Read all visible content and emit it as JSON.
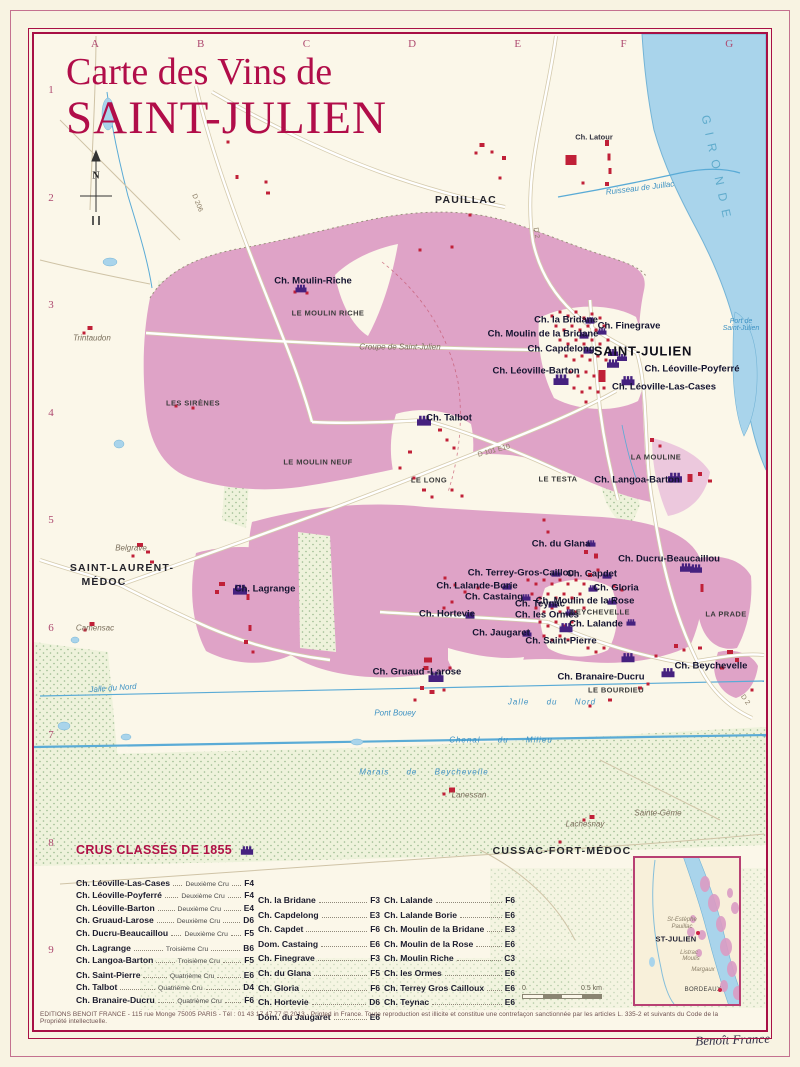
{
  "poster": {
    "title_line1": "Carte des Vins de",
    "title_line2": "SAINT-JULIEN",
    "signature": "Benoît France",
    "footer": "EDITIONS BENOIT FRANCE - 115 rue Monge 75005 PARIS - Tél : 01 43 17 47 77 © 2013 - Printed in France. Toute reproduction est illicite et constitue une contrefaçon sanctionnée par les articles L. 335-2 et suivants du Code de la Propriété intellectuelle."
  },
  "colors": {
    "crimson": "#a80f45",
    "vineyard_pink": "#dfa3c7",
    "water_blue": "#a9d4eb",
    "chateau_purple": "#45217f",
    "building_red": "#c02038",
    "woods_green": "#9cbb90"
  },
  "grid": {
    "letters": [
      "A",
      "B",
      "C",
      "D",
      "E",
      "F",
      "G"
    ],
    "numbers": [
      "1",
      "2",
      "3",
      "4",
      "5",
      "6",
      "7",
      "8",
      "9"
    ]
  },
  "map_labels": [
    {
      "t": "N",
      "x": 96,
      "y": 176,
      "c": "compass-n",
      "n": "compass-north-label"
    },
    {
      "t": "PAUILLAC",
      "x": 466,
      "y": 200,
      "c": "town"
    },
    {
      "t": "SAINT-JULIEN",
      "x": 643,
      "y": 351,
      "c": "town-lg"
    },
    {
      "t": "SAINT-LAURENT-",
      "x": 122,
      "y": 568,
      "c": "town"
    },
    {
      "t": "MÉDOC",
      "x": 104,
      "y": 582,
      "c": "town"
    },
    {
      "t": "CUSSAC-FORT-MÉDOC",
      "x": 562,
      "y": 851,
      "c": "town"
    },
    {
      "t": "GIRONDE",
      "x": 717,
      "y": 170,
      "c": "gironde",
      "r": 78
    },
    {
      "t": "Ch. Latour",
      "x": 594,
      "y": 137,
      "c": "chateau-sm"
    },
    {
      "t": "Ruisseau  de Juillac",
      "x": 640,
      "y": 188,
      "c": "water",
      "r": -7
    },
    {
      "t": "Port de\nSaint-Julien",
      "x": 741,
      "y": 325,
      "c": "water-multi"
    },
    {
      "t": "Trintaudon",
      "x": 92,
      "y": 338,
      "c": "loc"
    },
    {
      "t": "Ch. Moulin-Riche",
      "x": 313,
      "y": 281,
      "c": "chateau"
    },
    {
      "t": "LE MOULIN RICHE",
      "x": 328,
      "y": 313,
      "c": "hamlet"
    },
    {
      "t": "Croupe de Saint-Julien",
      "x": 400,
      "y": 347,
      "c": "loc"
    },
    {
      "t": "LES SIRÈNES",
      "x": 193,
      "y": 403,
      "c": "hamlet"
    },
    {
      "t": "Ch. Talbot",
      "x": 449,
      "y": 418,
      "c": "chateau"
    },
    {
      "t": "LE MOULIN NEUF",
      "x": 318,
      "y": 462,
      "c": "hamlet"
    },
    {
      "t": "LE LONG",
      "x": 429,
      "y": 480,
      "c": "hamlet"
    },
    {
      "t": "LE TESTA",
      "x": 558,
      "y": 479,
      "c": "hamlet"
    },
    {
      "t": "LA MOULINE",
      "x": 656,
      "y": 457,
      "c": "hamlet"
    },
    {
      "t": "Ch. Langoa-Barton",
      "x": 637,
      "y": 480,
      "c": "chateau"
    },
    {
      "t": "Ch. la Bridane",
      "x": 566,
      "y": 320,
      "c": "chateau"
    },
    {
      "t": "Ch. Finegrave",
      "x": 629,
      "y": 326,
      "c": "chateau"
    },
    {
      "t": "Ch. Moulin de la Bridane",
      "x": 543,
      "y": 334,
      "c": "chateau"
    },
    {
      "t": "Ch. Capdelong",
      "x": 561,
      "y": 349,
      "c": "chateau"
    },
    {
      "t": "Ch. Léoville-Barton",
      "x": 536,
      "y": 371,
      "c": "chateau"
    },
    {
      "t": "Ch. Léoville-Poyferré",
      "x": 692,
      "y": 369,
      "c": "chateau"
    },
    {
      "t": "Ch. Léoville-Las-Cases",
      "x": 664,
      "y": 387,
      "c": "chateau"
    },
    {
      "t": "D 101 E10",
      "x": 494,
      "y": 451,
      "c": "road",
      "r": -15
    },
    {
      "t": "D 206",
      "x": 197,
      "y": 203,
      "c": "road",
      "r": 68
    },
    {
      "t": "D 2",
      "x": 536,
      "y": 233,
      "c": "road",
      "r": 80
    },
    {
      "t": "D 2",
      "x": 745,
      "y": 700,
      "c": "road",
      "r": 55
    },
    {
      "t": "Ch. du Glana",
      "x": 561,
      "y": 544,
      "c": "chateau"
    },
    {
      "t": "Ch. Ducru-Beaucaillou",
      "x": 669,
      "y": 559,
      "c": "chateau"
    },
    {
      "t": "Ch. Terrey-Gros-Caillou",
      "x": 521,
      "y": 573,
      "c": "chateau"
    },
    {
      "t": "Ch. Capdet",
      "x": 592,
      "y": 574,
      "c": "chateau"
    },
    {
      "t": "Ch. Lalande-Borie",
      "x": 477,
      "y": 586,
      "c": "chateau"
    },
    {
      "t": "Ch. Gloria",
      "x": 616,
      "y": 588,
      "c": "chateau"
    },
    {
      "t": "Ch. Castaing",
      "x": 494,
      "y": 597,
      "c": "chateau"
    },
    {
      "t": "Ch. Moulin de la Rose",
      "x": 585,
      "y": 601,
      "c": "chateau"
    },
    {
      "t": "BEYCHEVELLE",
      "x": 600,
      "y": 612,
      "c": "hamlet"
    },
    {
      "t": "Ch. Teynac",
      "x": 540,
      "y": 604,
      "c": "chateau"
    },
    {
      "t": "Ch. les Ormes",
      "x": 547,
      "y": 615,
      "c": "chateau"
    },
    {
      "t": "Ch. Hortevie",
      "x": 447,
      "y": 614,
      "c": "chateau"
    },
    {
      "t": "Ch. Lalande",
      "x": 596,
      "y": 624,
      "c": "chateau"
    },
    {
      "t": "Ch. Jaugaret",
      "x": 501,
      "y": 633,
      "c": "chateau"
    },
    {
      "t": "Ch. Saint-Pierre",
      "x": 561,
      "y": 641,
      "c": "chateau"
    },
    {
      "t": "LA PRADE",
      "x": 726,
      "y": 614,
      "c": "hamlet"
    },
    {
      "t": "Ch. Gruaud -Larose",
      "x": 417,
      "y": 672,
      "c": "chateau"
    },
    {
      "t": "Ch. Branaire-Ducru",
      "x": 601,
      "y": 677,
      "c": "chateau"
    },
    {
      "t": "LE BOURDIEU",
      "x": 616,
      "y": 690,
      "c": "hamlet"
    },
    {
      "t": "Ch. Beychevelle",
      "x": 711,
      "y": 666,
      "c": "chateau"
    },
    {
      "t": "Pont Bouey",
      "x": 395,
      "y": 713,
      "c": "water"
    },
    {
      "t": "Jalle  du  Nord",
      "x": 552,
      "y": 702,
      "c": "water-sp"
    },
    {
      "t": "Chenal  du  Milieu",
      "x": 501,
      "y": 740,
      "c": "water-sp"
    },
    {
      "t": "Marais  de  Beychevelle",
      "x": 424,
      "y": 772,
      "c": "water-sp"
    },
    {
      "t": "Lanessan",
      "x": 469,
      "y": 795,
      "c": "loc"
    },
    {
      "t": "Sainte-Gème",
      "x": 658,
      "y": 813,
      "c": "loc"
    },
    {
      "t": "Lachesnay",
      "x": 585,
      "y": 824,
      "c": "loc"
    },
    {
      "t": "Belgrave",
      "x": 131,
      "y": 548,
      "c": "loc"
    },
    {
      "t": "Camensac",
      "x": 95,
      "y": 628,
      "c": "loc"
    },
    {
      "t": "Ch. Lagrange",
      "x": 265,
      "y": 589,
      "c": "chateau"
    },
    {
      "t": "Jalle du Nord",
      "x": 113,
      "y": 688,
      "c": "water",
      "r": -4
    }
  ],
  "chateau_icons": [
    [
      424,
      420,
      1.4
    ],
    [
      561,
      379,
      1.5
    ],
    [
      628,
      380,
      1.3
    ],
    [
      613,
      363,
      1.2
    ],
    [
      675,
      477,
      1.4
    ],
    [
      240,
      589,
      1.4
    ],
    [
      436,
      676,
      1.5
    ],
    [
      566,
      627,
      1.3
    ],
    [
      628,
      657,
      1.3
    ],
    [
      668,
      672,
      1.3
    ],
    [
      686,
      567,
      1.2
    ],
    [
      696,
      568,
      1.2
    ],
    [
      301,
      288,
      1.1
    ],
    [
      590,
      320,
      0.9
    ],
    [
      602,
      331,
      0.9
    ],
    [
      584,
      335,
      0.9
    ],
    [
      588,
      350,
      0.9
    ],
    [
      591,
      543,
      0.9
    ],
    [
      607,
      575,
      0.9
    ],
    [
      593,
      588,
      0.9
    ],
    [
      507,
      586,
      0.9
    ],
    [
      526,
      597,
      0.9
    ],
    [
      470,
      615,
      0.9
    ],
    [
      553,
      604,
      0.9
    ],
    [
      570,
      612,
      0.9
    ],
    [
      631,
      622,
      0.9
    ],
    [
      527,
      633,
      0.9
    ],
    [
      612,
      601,
      0.9
    ],
    [
      556,
      573,
      0.9
    ],
    [
      613,
      352,
      1
    ],
    [
      622,
      357,
      1
    ]
  ],
  "buildings": [
    [
      482,
      145,
      5,
      4
    ],
    [
      492,
      152
    ],
    [
      504,
      158,
      4,
      4
    ],
    [
      476,
      153
    ],
    [
      571,
      160,
      11,
      10
    ],
    [
      607,
      143,
      4,
      6
    ],
    [
      609,
      157,
      3,
      7
    ],
    [
      610,
      171,
      3,
      6
    ],
    [
      607,
      184,
      4,
      4
    ],
    [
      583,
      183
    ],
    [
      500,
      178
    ],
    [
      470,
      215
    ],
    [
      452,
      247
    ],
    [
      420,
      250
    ],
    [
      228,
      142
    ],
    [
      237,
      177,
      3,
      4
    ],
    [
      266,
      182
    ],
    [
      268,
      193,
      4,
      3
    ],
    [
      90,
      328,
      5,
      4
    ],
    [
      84,
      333
    ],
    [
      295,
      292
    ],
    [
      307,
      293
    ],
    [
      176,
      406
    ],
    [
      193,
      408
    ],
    [
      440,
      430,
      4,
      3
    ],
    [
      447,
      440
    ],
    [
      454,
      448
    ],
    [
      410,
      452,
      4,
      3
    ],
    [
      400,
      468
    ],
    [
      414,
      478
    ],
    [
      424,
      490,
      4,
      3
    ],
    [
      432,
      497
    ],
    [
      452,
      490
    ],
    [
      462,
      496
    ],
    [
      552,
      316
    ],
    [
      560,
      312
    ],
    [
      568,
      316
    ],
    [
      576,
      312
    ],
    [
      584,
      318
    ],
    [
      592,
      314
    ],
    [
      600,
      318
    ],
    [
      556,
      326
    ],
    [
      564,
      330
    ],
    [
      572,
      326
    ],
    [
      580,
      330
    ],
    [
      588,
      326
    ],
    [
      596,
      330
    ],
    [
      604,
      326
    ],
    [
      560,
      340
    ],
    [
      568,
      344
    ],
    [
      576,
      340
    ],
    [
      584,
      344
    ],
    [
      592,
      340
    ],
    [
      600,
      344
    ],
    [
      608,
      340
    ],
    [
      566,
      356
    ],
    [
      574,
      360
    ],
    [
      582,
      356
    ],
    [
      590,
      360
    ],
    [
      598,
      356
    ],
    [
      606,
      360
    ],
    [
      570,
      372
    ],
    [
      578,
      376
    ],
    [
      586,
      372
    ],
    [
      594,
      376
    ],
    [
      602,
      372
    ],
    [
      574,
      388
    ],
    [
      582,
      392
    ],
    [
      590,
      388
    ],
    [
      598,
      392
    ],
    [
      604,
      388
    ],
    [
      586,
      402
    ],
    [
      602,
      376,
      7,
      12
    ],
    [
      652,
      440,
      4,
      4
    ],
    [
      660,
      446
    ],
    [
      690,
      478,
      5,
      8
    ],
    [
      700,
      474,
      4,
      4
    ],
    [
      710,
      481,
      4,
      3
    ],
    [
      544,
      520
    ],
    [
      548,
      532
    ],
    [
      586,
      552,
      4,
      4
    ],
    [
      596,
      556,
      4,
      5
    ],
    [
      614,
      586
    ],
    [
      622,
      590
    ],
    [
      702,
      588,
      3,
      8
    ],
    [
      445,
      578
    ],
    [
      455,
      585
    ],
    [
      465,
      592
    ],
    [
      478,
      588
    ],
    [
      452,
      602
    ],
    [
      444,
      608
    ],
    [
      528,
      580
    ],
    [
      536,
      584
    ],
    [
      544,
      580
    ],
    [
      552,
      584
    ],
    [
      560,
      580
    ],
    [
      568,
      584
    ],
    [
      576,
      580
    ],
    [
      584,
      584
    ],
    [
      532,
      594
    ],
    [
      540,
      598
    ],
    [
      548,
      594
    ],
    [
      556,
      598
    ],
    [
      564,
      594
    ],
    [
      572,
      598
    ],
    [
      580,
      594
    ],
    [
      536,
      608
    ],
    [
      544,
      612
    ],
    [
      552,
      608
    ],
    [
      560,
      612
    ],
    [
      568,
      608
    ],
    [
      576,
      612
    ],
    [
      584,
      608
    ],
    [
      540,
      622
    ],
    [
      548,
      626
    ],
    [
      556,
      622
    ],
    [
      564,
      626
    ],
    [
      572,
      622
    ],
    [
      544,
      636
    ],
    [
      552,
      640
    ],
    [
      560,
      636
    ],
    [
      568,
      640
    ],
    [
      590,
      575,
      4,
      4
    ],
    [
      598,
      570
    ],
    [
      222,
      584,
      6,
      4
    ],
    [
      217,
      592,
      4,
      4
    ],
    [
      248,
      597,
      3,
      6
    ],
    [
      250,
      628,
      3,
      6
    ],
    [
      246,
      642,
      4,
      4
    ],
    [
      253,
      652
    ],
    [
      140,
      545,
      6,
      4
    ],
    [
      148,
      552,
      4,
      3
    ],
    [
      133,
      556
    ],
    [
      152,
      562,
      4,
      3
    ],
    [
      92,
      624,
      5,
      4
    ],
    [
      85,
      630
    ],
    [
      428,
      660,
      8,
      5
    ],
    [
      426,
      668,
      5,
      4
    ],
    [
      422,
      688,
      4,
      4
    ],
    [
      432,
      692,
      5,
      4
    ],
    [
      444,
      690
    ],
    [
      450,
      668
    ],
    [
      415,
      700
    ],
    [
      588,
      648
    ],
    [
      596,
      652
    ],
    [
      604,
      648
    ],
    [
      640,
      688,
      4,
      3
    ],
    [
      648,
      684
    ],
    [
      610,
      700,
      4,
      3
    ],
    [
      590,
      706
    ],
    [
      656,
      656
    ],
    [
      730,
      652,
      6,
      4
    ],
    [
      737,
      660,
      4,
      4
    ],
    [
      722,
      668,
      4,
      3
    ],
    [
      700,
      648,
      4,
      3
    ],
    [
      752,
      690
    ],
    [
      676,
      646,
      4,
      4
    ],
    [
      684,
      650
    ],
    [
      452,
      790,
      6,
      5
    ],
    [
      444,
      794
    ],
    [
      592,
      817,
      5,
      4
    ],
    [
      584,
      820
    ],
    [
      560,
      842
    ]
  ],
  "legend": {
    "heading": "CRUS CLASSÉS DE 1855",
    "col1": [
      {
        "name": "Ch. Léoville-Las-Cases",
        "cru": "Deuxième Cru",
        "ref": "F4"
      },
      {
        "name": "Ch. Léoville-Poyferré",
        "cru": "Deuxième Cru",
        "ref": "F4"
      },
      {
        "name": "Ch. Léoville-Barton",
        "cru": "Deuxième Cru",
        "ref": "E4"
      },
      {
        "name": "Ch. Gruaud-Larose",
        "cru": "Deuxième Cru",
        "ref": "D6"
      },
      {
        "name": "Ch. Ducru-Beaucaillou",
        "cru": "Deuxième Cru",
        "ref": "F5"
      },
      {
        "name": "Ch. Lagrange",
        "cru": "Troisième Cru",
        "ref": "B6",
        "gap": 1
      },
      {
        "name": "Ch. Langoa-Barton",
        "cru": "Troisième Cru",
        "ref": "F5"
      },
      {
        "name": "Ch. Saint-Pierre",
        "cru": "Quatrième Cru",
        "ref": "E6",
        "gap": 1
      },
      {
        "name": "Ch. Talbot",
        "cru": "Quatrième Cru",
        "ref": "D4"
      },
      {
        "name": "Ch. Branaire-Ducru",
        "cru": "Quatrième Cru",
        "ref": "F6"
      }
    ],
    "col2": [
      {
        "name": "Ch. la Bridane",
        "ref": "F3"
      },
      {
        "name": "Ch. Capdelong",
        "ref": "E3"
      },
      {
        "name": "Ch. Capdet",
        "ref": "F6"
      },
      {
        "name": "Dom. Castaing",
        "ref": "E6"
      },
      {
        "name": "Ch. Finegrave",
        "ref": "F3"
      },
      {
        "name": "Ch. du Glana",
        "ref": "F5"
      },
      {
        "name": "Ch. Gloria",
        "ref": "F6"
      },
      {
        "name": "Ch. Hortevie",
        "ref": "D6"
      },
      {
        "name": "Dom. du Jaugaret",
        "ref": "E6"
      }
    ],
    "col3": [
      {
        "name": "Ch. Lalande",
        "ref": "F6"
      },
      {
        "name": "Ch. Lalande Borie",
        "ref": "E6"
      },
      {
        "name": "Ch. Moulin de la Bridane",
        "ref": "E3"
      },
      {
        "name": "Ch. Moulin de la Rose",
        "ref": "E6"
      },
      {
        "name": "Ch. Moulin Riche",
        "ref": "C3"
      },
      {
        "name": "Ch. les Ormes",
        "ref": "E6"
      },
      {
        "name": "Ch. Terrey Gros Cailloux",
        "ref": "E6"
      },
      {
        "name": "Ch. Teynac",
        "ref": "E6"
      }
    ]
  },
  "scalebar": {
    "zero": "0",
    "label": "0.5 km"
  },
  "inset": {
    "labels": [
      {
        "t": "St-Estèphe",
        "x": 47,
        "y": 62,
        "c": "in-loc"
      },
      {
        "t": "Pauillac",
        "x": 47,
        "y": 69,
        "c": "in-loc"
      },
      {
        "t": "ST-JULIEN",
        "x": 41,
        "y": 81,
        "c": "in-town"
      },
      {
        "t": "Listrac",
        "x": 54,
        "y": 95,
        "c": "in-loc"
      },
      {
        "t": "Moulis",
        "x": 56,
        "y": 101,
        "c": "in-loc"
      },
      {
        "t": "Margaux",
        "x": 68,
        "y": 112,
        "c": "in-loc"
      },
      {
        "t": "BORDEAUX",
        "x": 68,
        "y": 132,
        "c": "in-city"
      }
    ],
    "dots": [
      {
        "x": 63,
        "y": 75
      },
      {
        "x": 85,
        "y": 132
      }
    ]
  }
}
